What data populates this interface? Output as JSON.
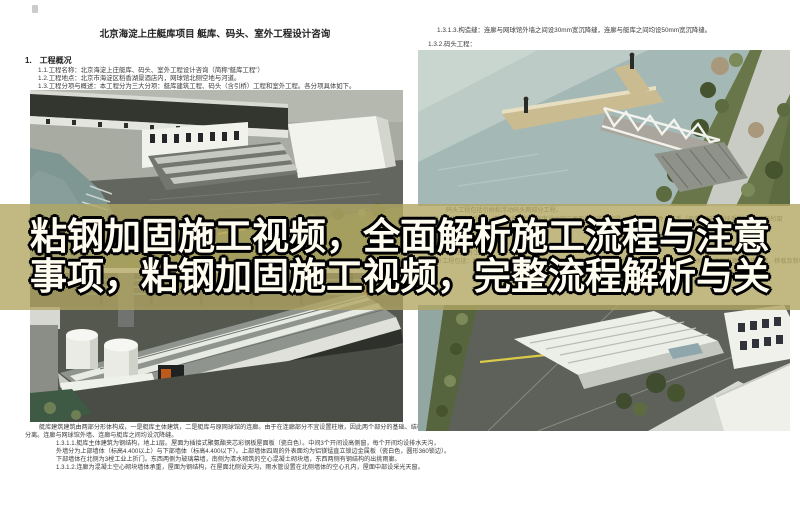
{
  "banner": {
    "line1": "粘钢加固施工视频，全面解析施工流程与注意",
    "line2": "事项，粘钢加固施工视频，完整流程解析与关",
    "text_color": "#fffdf0",
    "outline_color": "#000000",
    "band_color": "rgba(177,166,99,0.80)"
  },
  "left_page": {
    "title": "北京海淀上庄艇库项目 艇库、码头、室外工程设计咨询",
    "section_heading": "1.　工程概况",
    "intro_lines": [
      "1.1.工程名称：北京海淀上庄艇库、码头、室外工程设计咨询（简称“艇库工程”）",
      "1.2.工程地点：北京市海淀区稻香湖景酒店内，网球馆北侧空地与河道。",
      "1.3.工程分项与概述：本工程分为三大分项：艇库建筑工程、码头（含引桥）工程和室外工程。各分项具体如下。"
    ],
    "caption_under_overlay": "1.3.1.艇库建筑工程：",
    "bottom_paragraph": [
      "艇库建筑建筑由两部分形体构成，一是艇库主体建筑，二是艇库与原网球馆的连廊。由于在连廊部分不宜设置柱墩，因此两个部分的基础、结构",
      "分离。连廊与网球馆外墙、连廊与艇库之间均设沉降缝。",
      "1.3.1.1.艇库主体建筑为钢结构，地上1层。屋面为插接式聚氨酯夹芯彩钢板屋面板（瓷白色）。中间3个开间设高侧窗，每个开间均设排水天沟，",
      "外墙分为上部墙体（标高4.400以上）与下部墙体（标高4.400以下）。上部墙体四周的外表面均为铝镁锰直立锁边金属板（瓷白色，圆形360锁边）。",
      "下部墙体在北侧为3樘工业上折门。东西两侧为玻璃幕墙，南侧为清水砌筑的空心混凝土砌块墙，东西两侧有钢结构的出挑雨廊。",
      "1.3.1.2.连廊为混凝土空心砌块墙体承重，屋面为钢结构，在屋面北侧设天沟，雨水管设置在北侧墙体的空心孔内，屋面中部设采光天窗。"
    ]
  },
  "right_page": {
    "top_lines": [
      "1.3.1.3.构造缝：连廊与网球馆外墙之间设30mm宽沉降缝，连廊与艇库之间均设50mm宽沉降缝。",
      "1.3.2.码头工程："
    ],
    "under_overlay_lines": [
      "码头工程包括引桥和浮动码头两部分工程。",
      "1.3.2.1.引桥为钢结构，两侧为利用栏杆高度设计的三角形截面的桁架梁，梁的上弦杆件为扶手（局部附加玻璃扶手板），三角形桁架梁之间",
      "1.3.3.室外工程：",
      "室外工程包括：给排水及强弱电的外线工程，艇库四周场地的铺装工程（包括其中的室外台阶），雨水沟和连接道路的土建工程，移栽及新种树木"
    ]
  },
  "images": {
    "render_boathouse_aerial": "aerial rendering of boathouse site with water and parking",
    "render_boathouse_closeup": "close-up rendering of boathouse roofs with tanks",
    "render_dock_bridge": "rendering of pier and truss footbridge over river",
    "render_site_overview": "aerial rendering of site roads and buildings",
    "palette": {
      "water": "#a4b9b5",
      "roof_gray": "#90948f",
      "tree_green": "#57653e",
      "dock_tan": "#cbbb90",
      "asphalt": "#5d6159"
    }
  }
}
